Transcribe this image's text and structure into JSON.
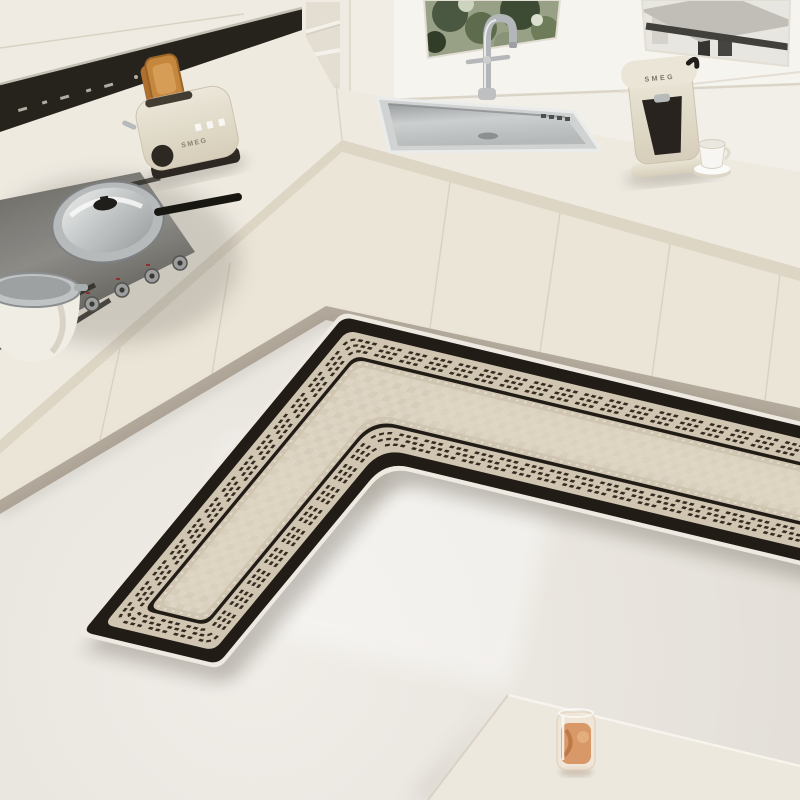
{
  "image": {
    "type": "photograph",
    "subject": "L-shaped black and cream kitchen floor mat laid in a corner kitchen",
    "style": "bright minimal cream kitchen, angled top-down product photo"
  },
  "colors": {
    "floor": "#e9e5df",
    "floor-light": "#f5f2ee",
    "wall": "#f6f3ed",
    "window-frame": "#faf8f4",
    "cab": "#f3efe7",
    "cab-face": "#efe9dc",
    "cab-line": "#d9d1c1",
    "counter": "#f3eee5",
    "counter-edge": "#e1d9c9",
    "plinth": "#b5ac9e",
    "hood": "#24201b",
    "hood-trim": "#c8c3b9",
    "steel": "#c6c9ca",
    "steel-mid": "#a6aaac",
    "steel-dark": "#7e8285",
    "cream-app": "#e9e2d2",
    "app-dark": "#2b2620",
    "toast": "#c8883c",
    "pane-green": "#99a287",
    "greenery-dark": "#3c4a33",
    "roof": "#c4c1ba",
    "roof-dark": "#3f3e3a",
    "rug-edge": "#f2eee7",
    "rug-black": "#1f1915",
    "rug-band": "#d3c8b4",
    "rug-field": "#dcd3c1",
    "rug-dash": "#33291f",
    "table": "#f1ece3",
    "juice": "#d9915f",
    "shadow": "#5c544a"
  },
  "objects": {
    "range_hood": {
      "name": "black range hood strip with control marks"
    },
    "upper_cabinets": {
      "name": "white upper cabinets"
    },
    "open_shelf": {
      "name": "open shelf niche column"
    },
    "window": {
      "name": "kitchen window",
      "panes": [
        "garden greenery",
        "neighbor house roof"
      ]
    },
    "sink": {
      "name": "stainless steel sink with chrome gooseneck faucet"
    },
    "toaster": {
      "name": "retro cream toaster with toast",
      "brand_label": "SMEG"
    },
    "coffee_machine": {
      "name": "retro cream espresso machine",
      "brand_label": "SMEG"
    },
    "coffee_cup": {
      "name": "white cup on saucer"
    },
    "cooktop": {
      "name": "stainless gas cooktop",
      "items": [
        "glass-lid wok pan",
        "white stock pot"
      ],
      "knob_count": 5
    },
    "base_cabinets": {
      "name": "cream handleless base cabinets"
    },
    "rug": {
      "name": "L-shaped corner kitchen mat",
      "border": "thick black border with light binding edge",
      "band": "beige band with three rows of dashed ticks",
      "inner": "thin black keyline around beige check field"
    },
    "table": {
      "name": "white table corner"
    },
    "juice_glass": {
      "name": "glass of orange juice"
    }
  }
}
